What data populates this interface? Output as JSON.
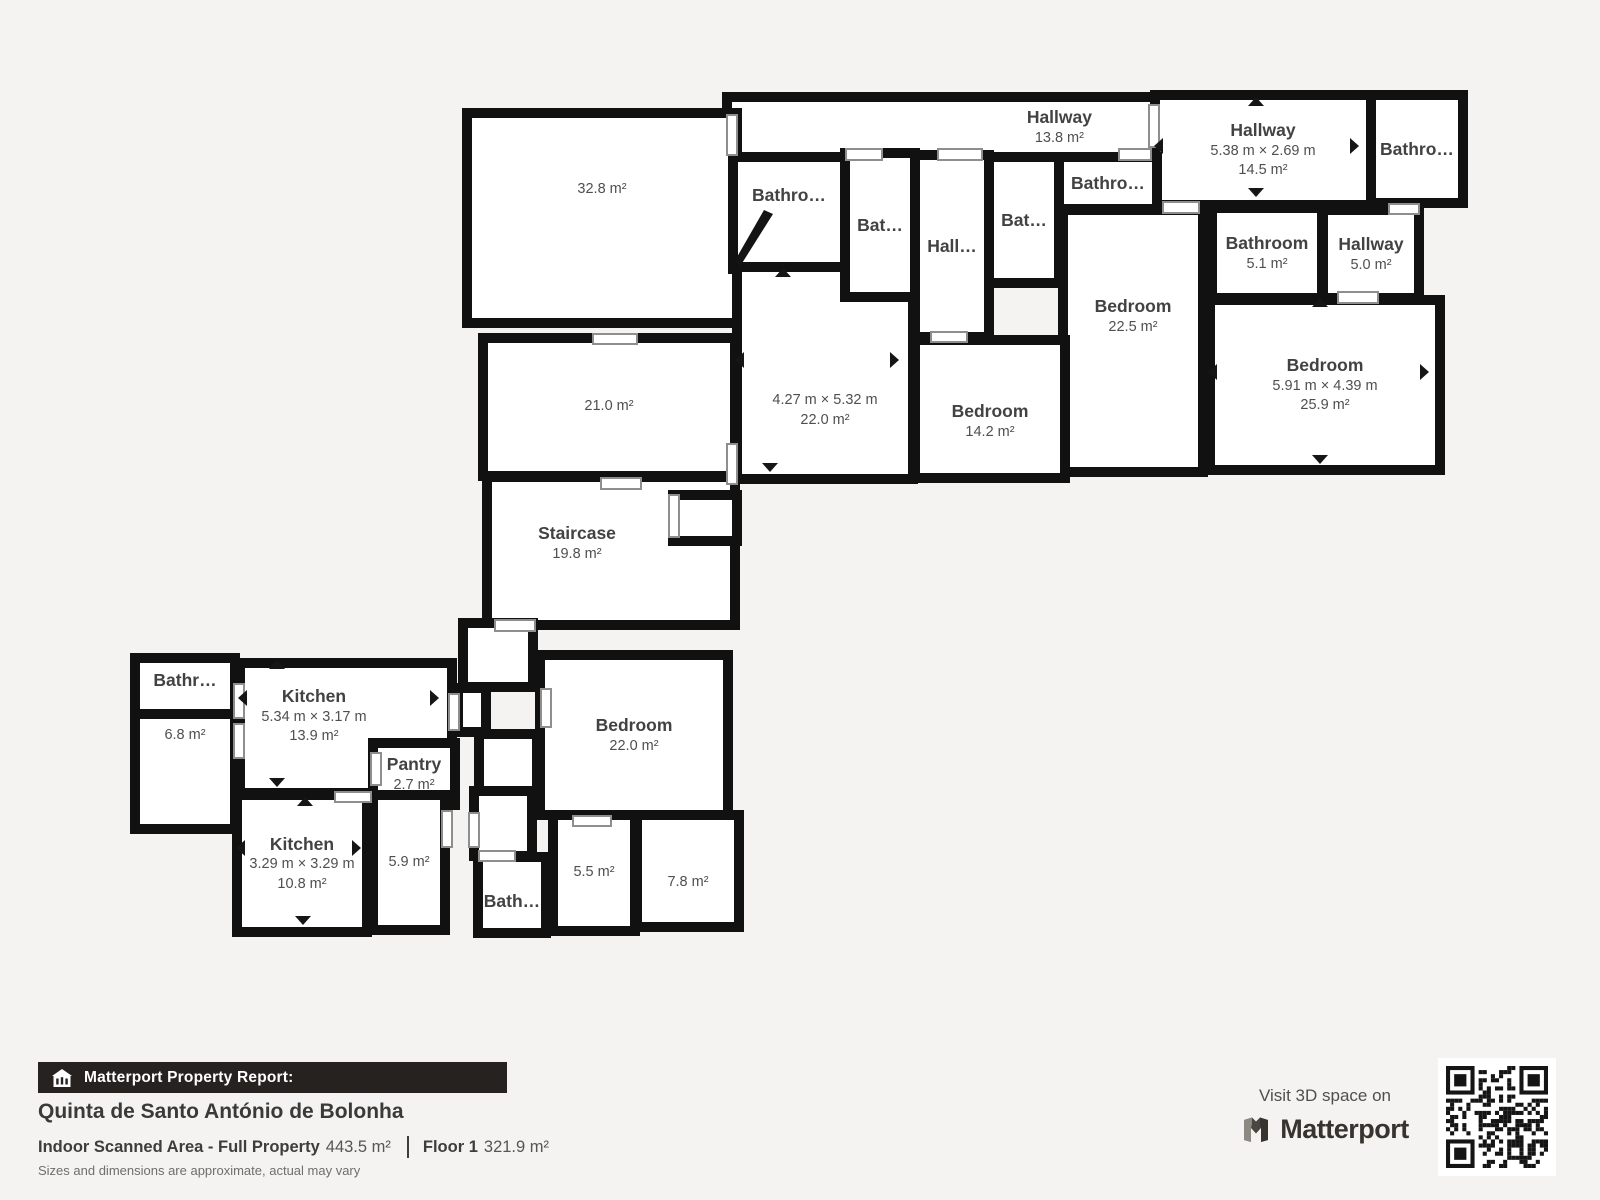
{
  "floorplan": {
    "rooms": [
      {
        "id": "hallway-top",
        "label": "Hallway",
        "dims": "",
        "area": "13.8 m²"
      },
      {
        "id": "hallway-right",
        "label": "Hallway",
        "dims": "5.38 m × 2.69 m",
        "area": "14.5 m²"
      },
      {
        "id": "bathroom-top-right",
        "label": "Bathro…",
        "dims": "",
        "area": ""
      },
      {
        "id": "bathroom-1",
        "label": "Bathro…",
        "dims": "",
        "area": ""
      },
      {
        "id": "bathroom-2",
        "label": "Bat…",
        "dims": "",
        "area": ""
      },
      {
        "id": "hallway-small",
        "label": "Hall…",
        "dims": "",
        "area": ""
      },
      {
        "id": "bathroom-3",
        "label": "Bat…",
        "dims": "",
        "area": ""
      },
      {
        "id": "bathroom-4",
        "label": "Bathro…",
        "dims": "",
        "area": ""
      },
      {
        "id": "bathroom-51",
        "label": "Bathroom",
        "dims": "",
        "area": "5.1 m²"
      },
      {
        "id": "hallway-50",
        "label": "Hallway",
        "dims": "",
        "area": "5.0 m²"
      },
      {
        "id": "room-328",
        "label": "",
        "dims": "",
        "area": "32.8 m²"
      },
      {
        "id": "room-210",
        "label": "",
        "dims": "",
        "area": "21.0 m²"
      },
      {
        "id": "room-220-center",
        "label": "",
        "dims": "4.27 m × 5.32 m",
        "area": "22.0 m²"
      },
      {
        "id": "bedroom-142",
        "label": "Bedroom",
        "dims": "",
        "area": "14.2 m²"
      },
      {
        "id": "bedroom-225",
        "label": "Bedroom",
        "dims": "",
        "area": "22.5 m²"
      },
      {
        "id": "bedroom-259",
        "label": "Bedroom",
        "dims": "5.91 m × 4.39 m",
        "area": "25.9 m²"
      },
      {
        "id": "staircase",
        "label": "Staircase",
        "dims": "",
        "area": "19.8 m²"
      },
      {
        "id": "bathroom-lower-left",
        "label": "Bathr…",
        "dims": "",
        "area": ""
      },
      {
        "id": "room-68",
        "label": "",
        "dims": "",
        "area": "6.8 m²"
      },
      {
        "id": "kitchen-139",
        "label": "Kitchen",
        "dims": "5.34 m × 3.17 m",
        "area": "13.9 m²"
      },
      {
        "id": "pantry",
        "label": "Pantry",
        "dims": "",
        "area": "2.7 m²"
      },
      {
        "id": "kitchen-108",
        "label": "Kitchen",
        "dims": "3.29 m × 3.29 m",
        "area": "10.8 m²"
      },
      {
        "id": "room-59",
        "label": "",
        "dims": "",
        "area": "5.9 m²"
      },
      {
        "id": "bathroom-bottom",
        "label": "Bath…",
        "dims": "",
        "area": ""
      },
      {
        "id": "bedroom-220",
        "label": "Bedroom",
        "dims": "",
        "area": "22.0 m²"
      },
      {
        "id": "room-55",
        "label": "",
        "dims": "",
        "area": "5.5 m²"
      },
      {
        "id": "room-78",
        "label": "",
        "dims": "",
        "area": "7.8 m²"
      }
    ]
  },
  "footer": {
    "report_label": "Matterport Property Report:",
    "property_title": "Quinta de Santo António de Bolonha",
    "scanned_area_label": "Indoor Scanned Area - Full Property",
    "scanned_area_value": "443.5 m²",
    "floor_label": "Floor 1",
    "floor_value": "321.9 m²",
    "disclaimer": "Sizes and dimensions are approximate, actual may vary",
    "visit_text": "Visit 3D space on",
    "brand": "Matterport"
  },
  "colors": {
    "background": "#f4f3f1",
    "wall": "#111111",
    "room_fill": "#ffffff",
    "label_text": "#424242",
    "report_bar": "#262220",
    "brand_text": "#37332e"
  }
}
